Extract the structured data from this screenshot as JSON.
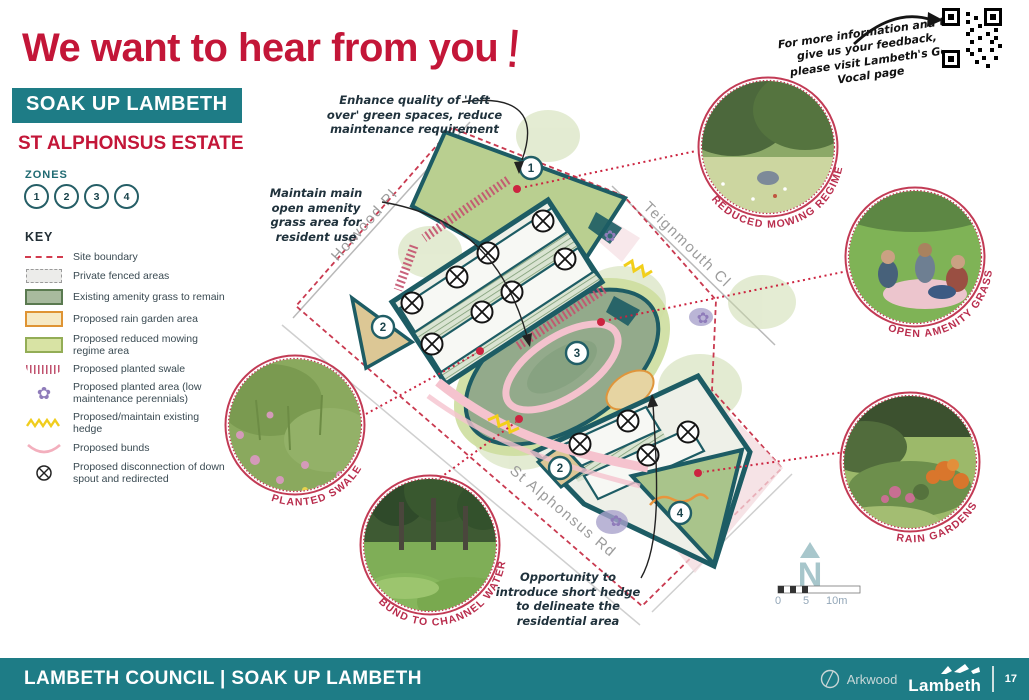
{
  "title": {
    "text": "We want to hear from you",
    "exclaim": "!"
  },
  "qr_note": {
    "text": "For more information and to give us your feedback, please visit Lambeth's Go Vocal page"
  },
  "sidebar": {
    "badge": "SOAK UP LAMBETH",
    "estate": "ST ALPHONSUS ESTATE",
    "zones_label": "ZONES",
    "zones": [
      "1",
      "2",
      "3",
      "4"
    ],
    "key_label": "KEY",
    "key_items": [
      {
        "icon": "site-boundary-swatch",
        "label": "Site boundary"
      },
      {
        "icon": "private-fenced-swatch",
        "label": "Private fenced areas"
      },
      {
        "icon": "amenity-grass-swatch",
        "label": "Existing amenity grass to remain"
      },
      {
        "icon": "rain-garden-swatch",
        "label": "Proposed rain garden area"
      },
      {
        "icon": "reduced-mowing-swatch",
        "label": "Proposed reduced mowing regime area"
      },
      {
        "icon": "planted-swale-swatch",
        "label": "Proposed planted swale"
      },
      {
        "icon": "planted-area-flower-icon",
        "label": "Proposed planted area (low maintenance perennials)"
      },
      {
        "icon": "hedge-zigzag-icon",
        "label": "Proposed/maintain existing hedge"
      },
      {
        "icon": "bund-arc-icon",
        "label": "Proposed bunds"
      },
      {
        "icon": "downspout-icon",
        "label": "Proposed disconnection of down spout and redirected"
      }
    ]
  },
  "map": {
    "streets": {
      "holwood": "Holwood Pl",
      "teignmouth": "Teignmouth Cl",
      "st_alphonsus": "St Alphonsus Rd"
    },
    "zone_markers": [
      "1",
      "2",
      "3",
      "2",
      "4"
    ],
    "annotations": [
      {
        "text": "Enhance quality of 'left over' green spaces, reduce maintenance requirement"
      },
      {
        "text": "Maintain main open amenity grass area for resident use"
      },
      {
        "text": "Opportunity to introduce short hedge to delineate the residential area"
      }
    ],
    "compass": "N",
    "scale_labels": [
      "0",
      "5",
      "10m"
    ]
  },
  "photos": [
    {
      "label": "REDUCED MOWING REGIME"
    },
    {
      "label": "OPEN AMENITY GRASS"
    },
    {
      "label": "PLANTED SWALE"
    },
    {
      "label": "BUND TO CHANNEL WATER"
    },
    {
      "label": "RAIN GARDENS"
    }
  ],
  "icons": {
    "flower": "✿"
  },
  "footer": {
    "title": "LAMBETH COUNCIL | SOAK UP LAMBETH",
    "arkwood": "Arkwood",
    "lambeth": "Lambeth",
    "page": "17"
  },
  "colors": {
    "accent_red": "#c31638",
    "teal": "#1e7c86",
    "map_outline": "#1d5c64",
    "boundary_red": "#c93a50"
  }
}
